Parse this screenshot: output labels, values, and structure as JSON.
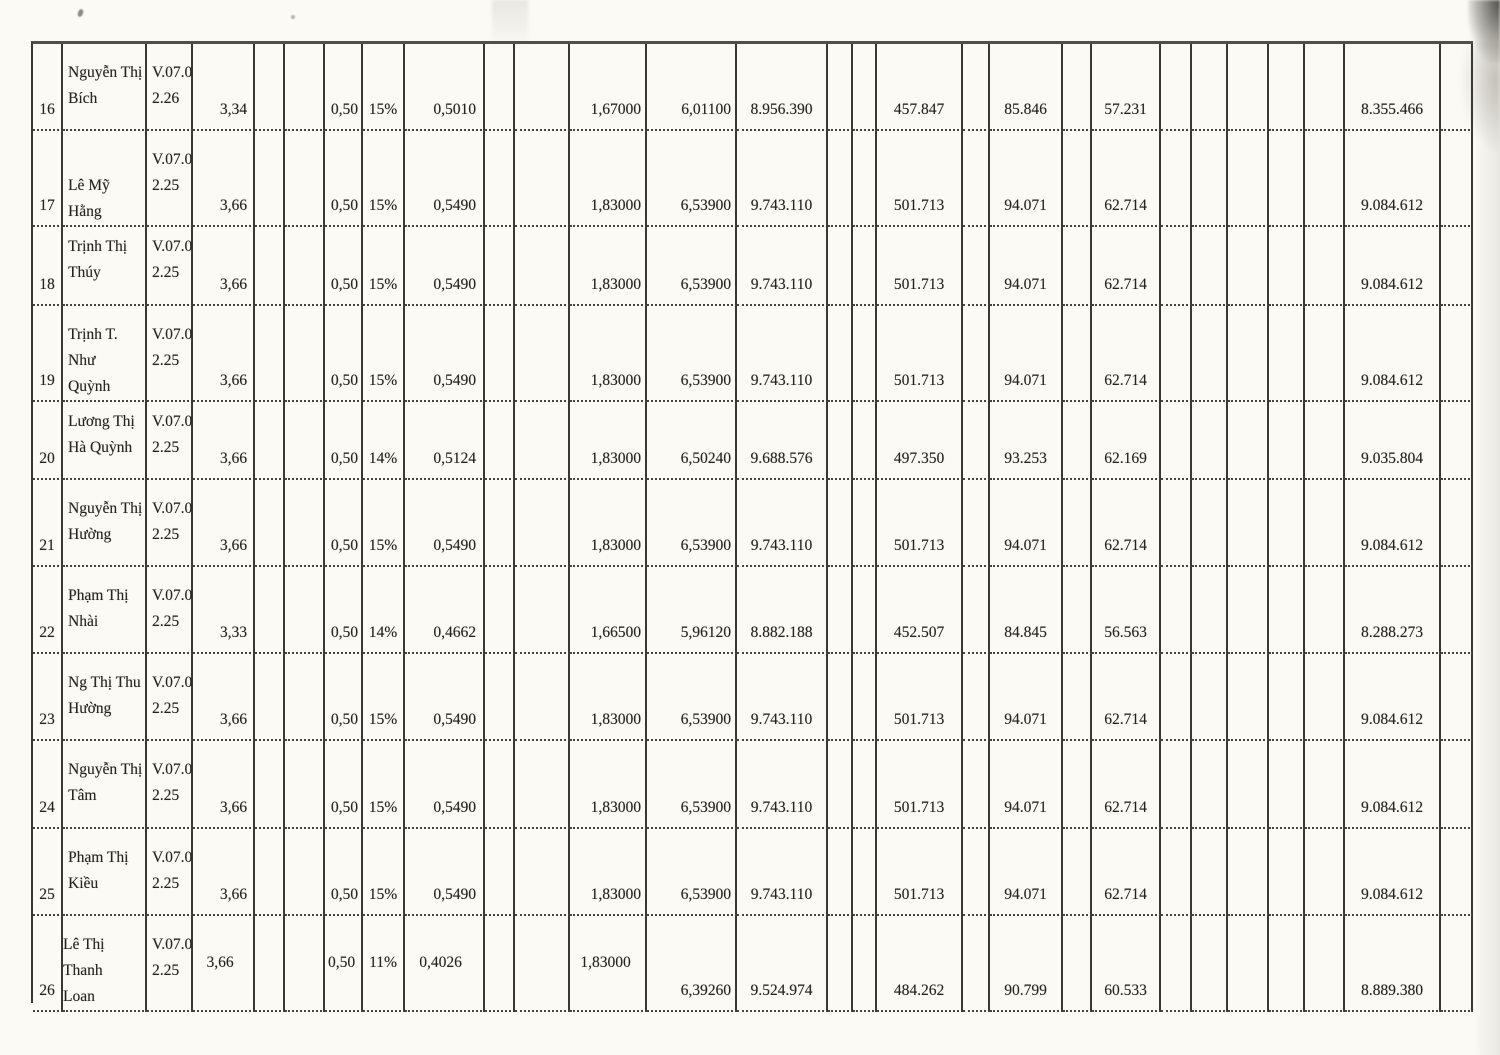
{
  "table": {
    "rows": [
      {
        "no": "16",
        "name": "Nguyễn Thị\nBích",
        "code": "V.07.0\n2.26",
        "coef": "3,34",
        "allow": "0,50",
        "pct": "15%",
        "pct_val": "0,5010",
        "base": "1,67000",
        "coef_total": "6,01100",
        "salary": "8.956.390",
        "ded_bhxh": "457.847",
        "ded_bhyt": "85.846",
        "ded_bhtn": "57.231",
        "net": "8.355.466"
      },
      {
        "no": "17",
        "name": "\nLê Mỹ Hằng",
        "code": "V.07.0\n2.25",
        "coef": "3,66",
        "allow": "0,50",
        "pct": "15%",
        "pct_val": "0,5490",
        "base": "1,83000",
        "coef_total": "6,53900",
        "salary": "9.743.110",
        "ded_bhxh": "501.713",
        "ded_bhyt": "94.071",
        "ded_bhtn": "62.714",
        "net": "9.084.612"
      },
      {
        "no": "18",
        "name": "Trịnh Thị\nThúy",
        "code": "V.07.0\n2.25",
        "coef": "3,66",
        "allow": "0,50",
        "pct": "15%",
        "pct_val": "0,5490",
        "base": "1,83000",
        "coef_total": "6,53900",
        "salary": "9.743.110",
        "ded_bhxh": "501.713",
        "ded_bhyt": "94.071",
        "ded_bhtn": "62.714",
        "net": "9.084.612"
      },
      {
        "no": "19",
        "name": "Trịnh T. Như\nQuỳnh",
        "code": "V.07.0\n2.25",
        "coef": "3,66",
        "allow": "0,50",
        "pct": "15%",
        "pct_val": "0,5490",
        "base": "1,83000",
        "coef_total": "6,53900",
        "salary": "9.743.110",
        "ded_bhxh": "501.713",
        "ded_bhyt": "94.071",
        "ded_bhtn": "62.714",
        "net": "9.084.612"
      },
      {
        "no": "20",
        "name": "Lương Thị\nHà Quỳnh",
        "code": "V.07.0\n2.25",
        "coef": "3,66",
        "allow": "0,50",
        "pct": "14%",
        "pct_val": "0,5124",
        "base": "1,83000",
        "coef_total": "6,50240",
        "salary": "9.688.576",
        "ded_bhxh": "497.350",
        "ded_bhyt": "93.253",
        "ded_bhtn": "62.169",
        "net": "9.035.804"
      },
      {
        "no": "21",
        "name": "Nguyễn Thị\nHường",
        "code": "V.07.0\n2.25",
        "coef": "3,66",
        "allow": "0,50",
        "pct": "15%",
        "pct_val": "0,5490",
        "base": "1,83000",
        "coef_total": "6,53900",
        "salary": "9.743.110",
        "ded_bhxh": "501.713",
        "ded_bhyt": "94.071",
        "ded_bhtn": "62.714",
        "net": "9.084.612"
      },
      {
        "no": "22",
        "name": "Phạm Thị\nNhài",
        "code": "V.07.0\n2.25",
        "coef": "3,33",
        "allow": "0,50",
        "pct": "14%",
        "pct_val": "0,4662",
        "base": "1,66500",
        "coef_total": "5,96120",
        "salary": "8.882.188",
        "ded_bhxh": "452.507",
        "ded_bhyt": "84.845",
        "ded_bhtn": "56.563",
        "net": "8.288.273"
      },
      {
        "no": "23",
        "name": "Ng Thị Thu\nHường",
        "code": "V.07.0\n2.25",
        "coef": "3,66",
        "allow": "0,50",
        "pct": "15%",
        "pct_val": "0,5490",
        "base": "1,83000",
        "coef_total": "6,53900",
        "salary": "9.743.110",
        "ded_bhxh": "501.713",
        "ded_bhyt": "94.071",
        "ded_bhtn": "62.714",
        "net": "9.084.612"
      },
      {
        "no": "24",
        "name": "Nguyễn Thị\nTâm",
        "code": "V.07.0\n2.25",
        "coef": "3,66",
        "allow": "0,50",
        "pct": "15%",
        "pct_val": "0,5490",
        "base": "1,83000",
        "coef_total": "6,53900",
        "salary": "9.743.110",
        "ded_bhxh": "501.713",
        "ded_bhyt": "94.071",
        "ded_bhtn": "62.714",
        "net": "9.084.612"
      },
      {
        "no": "25",
        "name": "Phạm Thị\nKiều",
        "code": "V.07.0\n2.25",
        "coef": "3,66",
        "allow": "0,50",
        "pct": "15%",
        "pct_val": "0,5490",
        "base": "1,83000",
        "coef_total": "6,53900",
        "salary": "9.743.110",
        "ded_bhxh": "501.713",
        "ded_bhyt": "94.071",
        "ded_bhtn": "62.714",
        "net": "9.084.612"
      },
      {
        "no": "26",
        "name": "Lê Thị Thanh\nLoan",
        "code": "V.07.0\n2.25",
        "split": true,
        "coef": "3,66",
        "allow": "0,50",
        "pct": "11%",
        "pct_val": "0,4026",
        "base": "1,83000",
        "coef_total": "6,39260",
        "salary": "9.524.974",
        "ded_bhxh": "484.262",
        "ded_bhyt": "90.799",
        "ded_bhtn": "60.533",
        "net": "8.889.380"
      }
    ]
  }
}
